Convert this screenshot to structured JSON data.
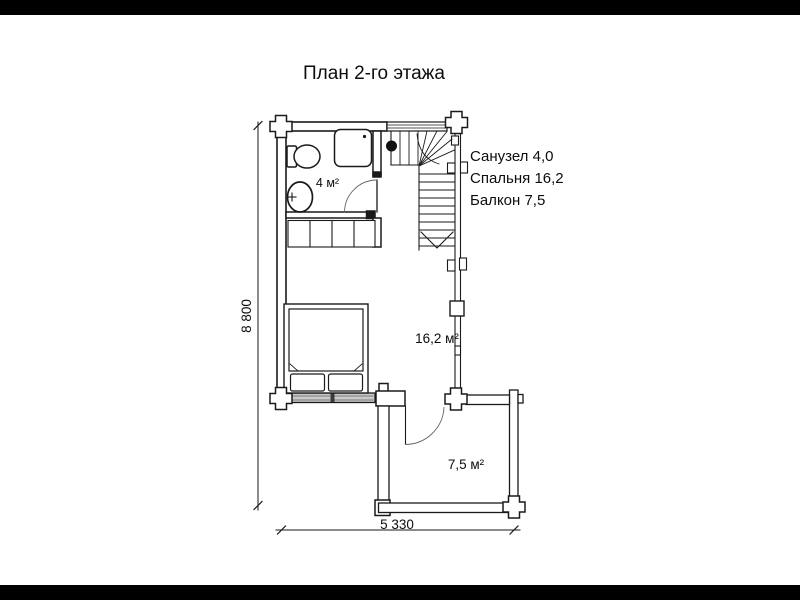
{
  "page": {
    "background": "#ffffff",
    "letterbox_color": "#000000"
  },
  "title": "План 2-го этажа",
  "legend": {
    "items": [
      {
        "label": "Санузел 4,0"
      },
      {
        "label": "Спальня 16,2"
      },
      {
        "label": "Балкон 7,5"
      }
    ]
  },
  "room_labels": {
    "bathroom": "4 м²",
    "bedroom": "16,2 м²",
    "balcony": "7,5 м²"
  },
  "dimensions": {
    "overall_height_mm": "8 800",
    "overall_width_mm": "5 330"
  },
  "drawing": {
    "line_color": "#1a1a1a",
    "window_fill": "#c9c9c9"
  }
}
